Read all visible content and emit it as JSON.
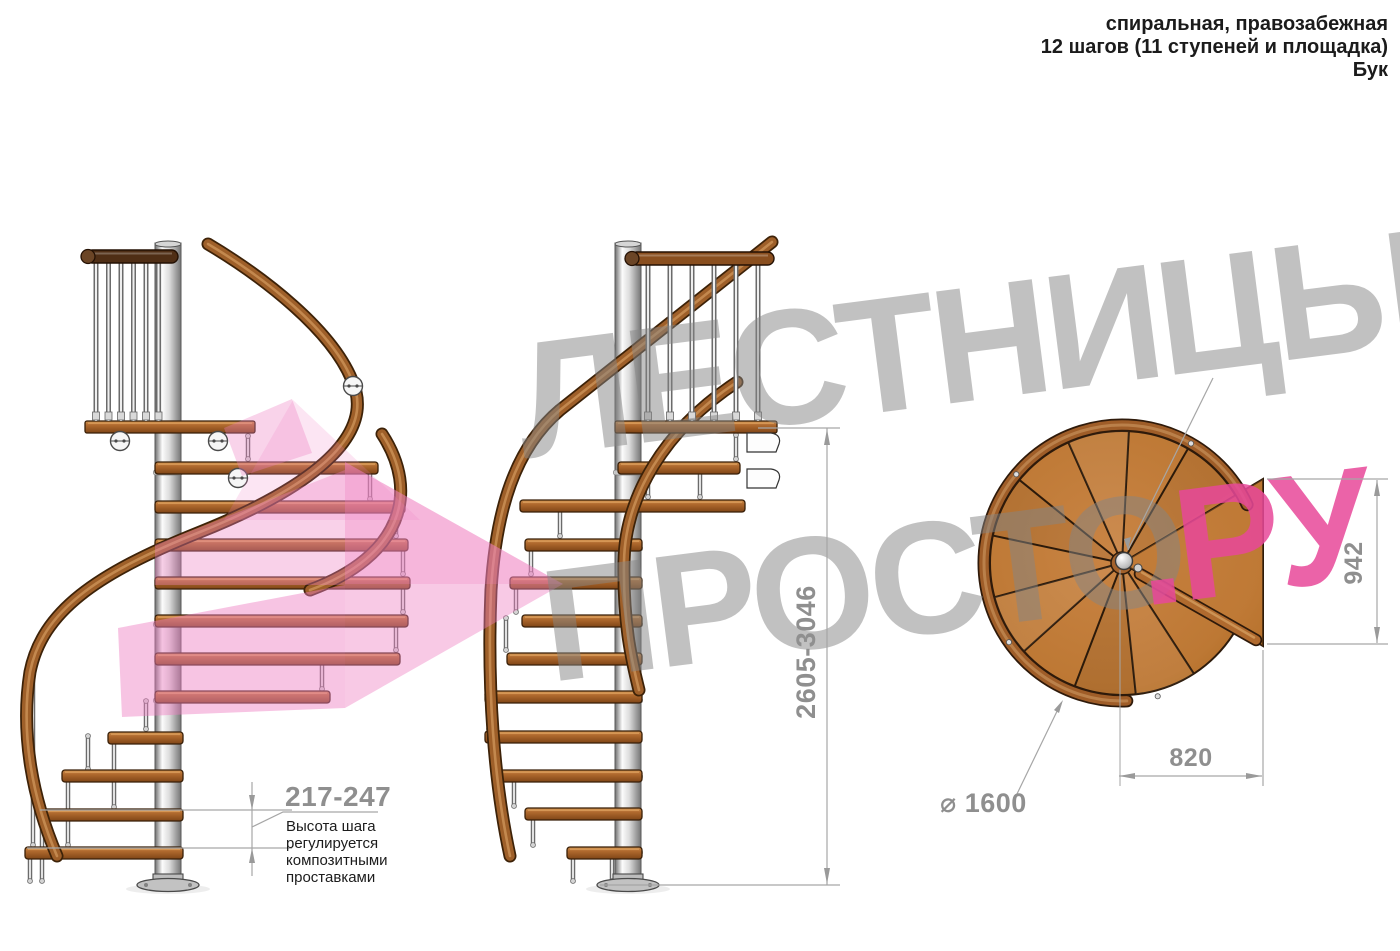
{
  "info": {
    "line1": "спиральная, правозабежная",
    "line2": "12 шагов (11 ступеней и площадка)",
    "line3": "Бук"
  },
  "watermark": {
    "word1": "ЛЕСТНИЦЫ",
    "word2": "ПРОСТО",
    "suffix": ".РУ",
    "gray_color": "#858585",
    "pink_color": "#e8489a",
    "arrow_color": "#ee7fc1"
  },
  "dims": {
    "total_height": "2605-3046",
    "step_height": "217-247",
    "landing_depth": "942",
    "landing_width": "820",
    "diameter": "⌀ 1600",
    "note": [
      "Высота шага",
      "регулируется",
      "композитными",
      "проставками"
    ]
  },
  "colors": {
    "wood_step": "#b06a2e",
    "wood_plan": "#bd7834",
    "handrail": "#9e5f29",
    "pole": "#d8d8d8",
    "dim_line": "#a6a6a6",
    "dim_text": "#8f8f8f",
    "note_text": "#1c1c1c"
  },
  "views": {
    "front_view": "вид сбоку 1",
    "back_view": "вид сбоку 2",
    "plan_view": "вид сверху"
  }
}
